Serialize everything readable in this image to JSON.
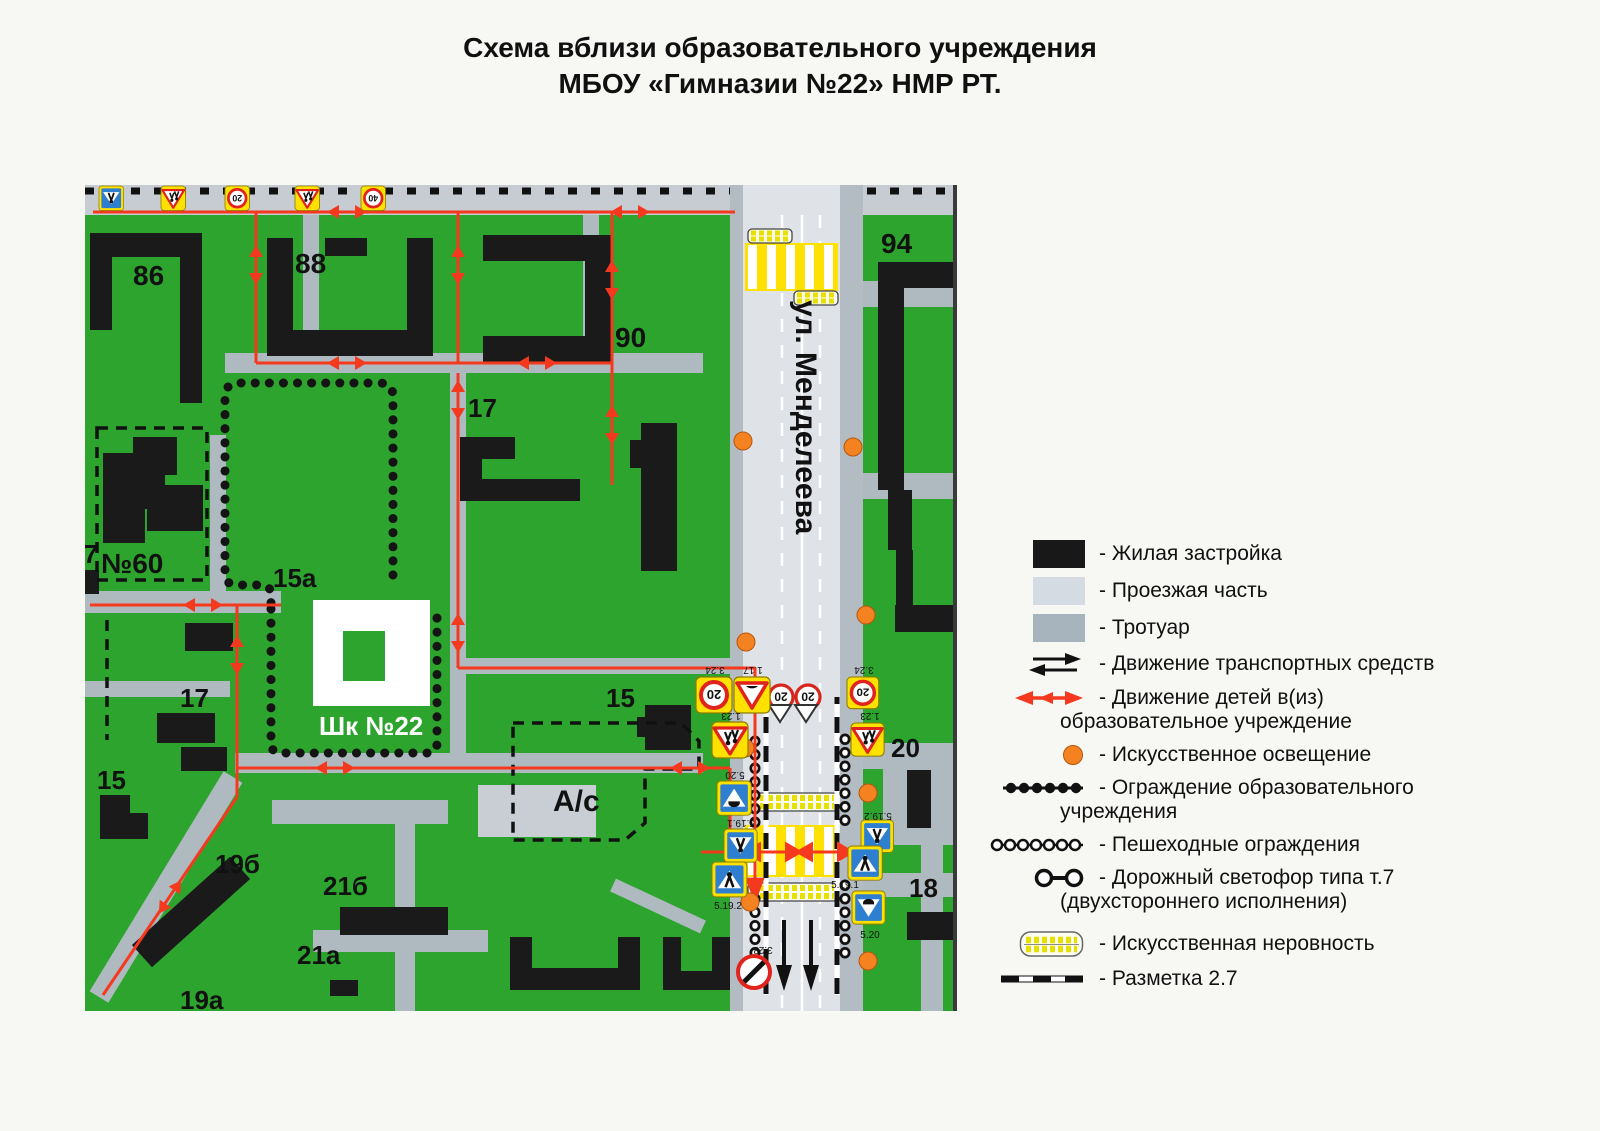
{
  "title": {
    "line1": "Схема вблизи образовательного учреждения",
    "line2": "МБОУ «Гимназии №22» НМР РТ."
  },
  "map": {
    "street_name": "ул. Менделеева",
    "labels": {
      "b86": "86",
      "b88": "88",
      "b90": "90",
      "b17_top": "17",
      "b60": "№60",
      "b15a": "15а",
      "school": "Шк №22",
      "b17_left": "17",
      "b17_edge": "17",
      "b15_left": "15",
      "b19b": "19б",
      "b21b": "21б",
      "b21a": "21а",
      "b19a": "19а",
      "b15_mid": "15",
      "parking": "А/с",
      "b94": "94",
      "b20": "20",
      "b18": "18"
    },
    "sign_codes": {
      "left_pair_a": "1.17",
      "left_pair_b": "3.24",
      "left_children": "1.23",
      "left_hump": "5.20",
      "left_ped1": "5.19.1",
      "left_ped2": "5.19.2",
      "right_limit": "3.24",
      "right_children": "1.23",
      "right_ped2": "5.19.2",
      "right_ped1": "5.19.1",
      "right_hump": "5.20",
      "bottom": "3.28"
    },
    "speed_values": {
      "limit20": "20",
      "limit40": "40"
    }
  },
  "legend": {
    "items": [
      {
        "icon": "block",
        "label": "- Жилая застройка"
      },
      {
        "icon": "road",
        "label": "- Проезжая часть"
      },
      {
        "icon": "sidewalk",
        "label": "- Тротуар"
      },
      {
        "icon": "arrows-black",
        "label": "- Движение транспортных средств"
      },
      {
        "icon": "arrows-red",
        "label": "- Движение детей в(из)",
        "label2": "образовательное учреждение"
      },
      {
        "icon": "lamp",
        "label": "- Искусственное освещение"
      },
      {
        "icon": "fence-solid",
        "label": "- Ограждение образовательного",
        "label2": "учреждения"
      },
      {
        "icon": "fence-rings",
        "label": "- Пешеходные ограждения"
      },
      {
        "icon": "signal",
        "label": "- Дорожный светофор типа т.7",
        "label2": "(двухстороннего исполнения)"
      },
      {
        "icon": "bump",
        "label": "- Искусственная неровность"
      },
      {
        "icon": "marking",
        "label": "- Разметка 2.7"
      }
    ]
  },
  "colors": {
    "green": "#2da42d",
    "roadway": "#dfe3e8",
    "sidewalk": "#aeb9c0",
    "route_red": "#f5391f",
    "lamp_orange": "#f58220",
    "sign_yellow": "#ffe100",
    "sign_blue": "#2e7fd0",
    "building_black": "#1a1a1a"
  }
}
